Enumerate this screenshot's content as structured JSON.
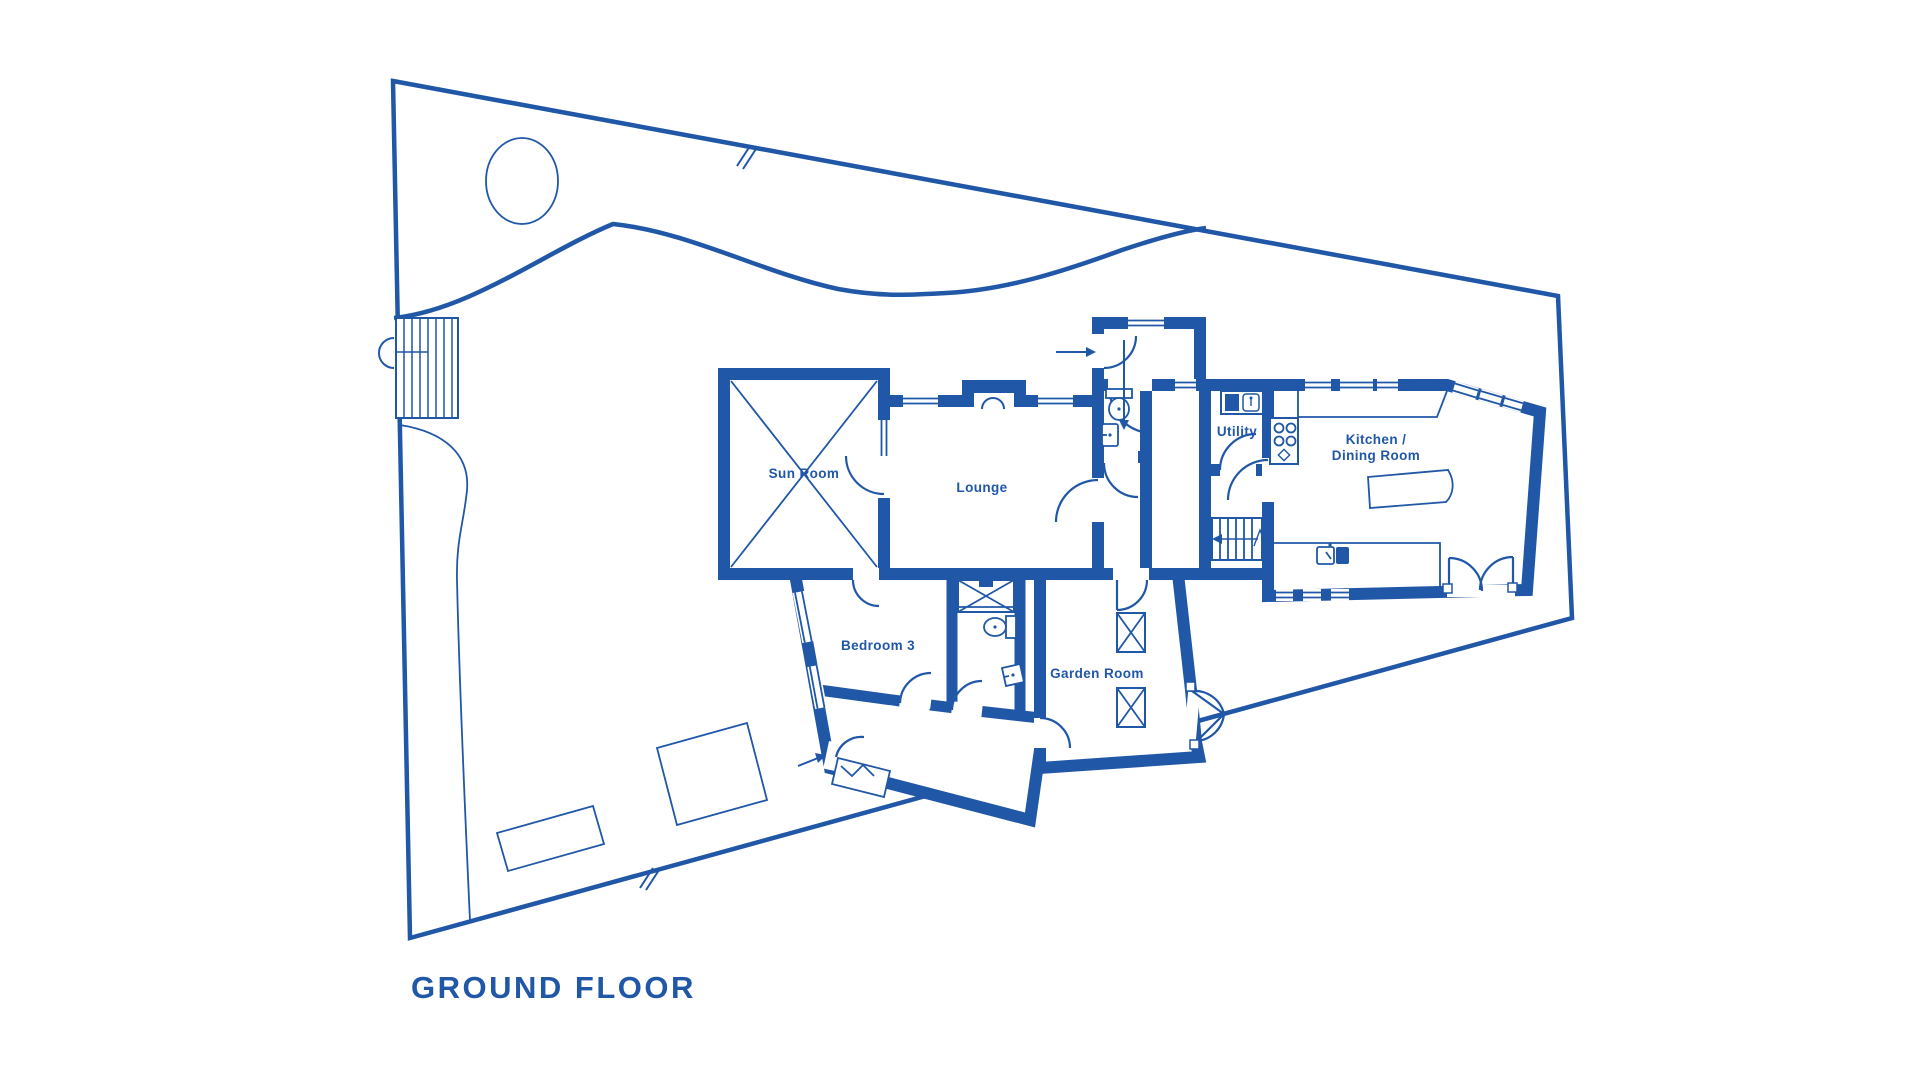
{
  "colors": {
    "ink": "#2057a7",
    "background": "#ffffff"
  },
  "title": "GROUND FLOOR",
  "floorplan": {
    "rooms": [
      {
        "id": "sun-room",
        "label": "Sun Room"
      },
      {
        "id": "lounge",
        "label": "Lounge"
      },
      {
        "id": "utility",
        "label": "Utility"
      },
      {
        "id": "kitchen-dining",
        "label_line1": "Kitchen /",
        "label_line2": "Dining Room"
      },
      {
        "id": "bedroom-3",
        "label": "Bedroom 3"
      },
      {
        "id": "garden-room",
        "label": "Garden Room"
      }
    ],
    "fixtures": [
      "staircase",
      "fireplace",
      "shower",
      "toilet",
      "washbasin",
      "kitchen-sink",
      "utility-sink",
      "hob",
      "kitchen-island",
      "wardrobe",
      "rooflights",
      "deck-steps"
    ],
    "site_features": [
      "property-boundary",
      "tree",
      "lawn-edge-curve",
      "garden-bed-curve",
      "patio-base",
      "shed-base",
      "boundary-break-marks",
      "entrance-arrows"
    ]
  }
}
